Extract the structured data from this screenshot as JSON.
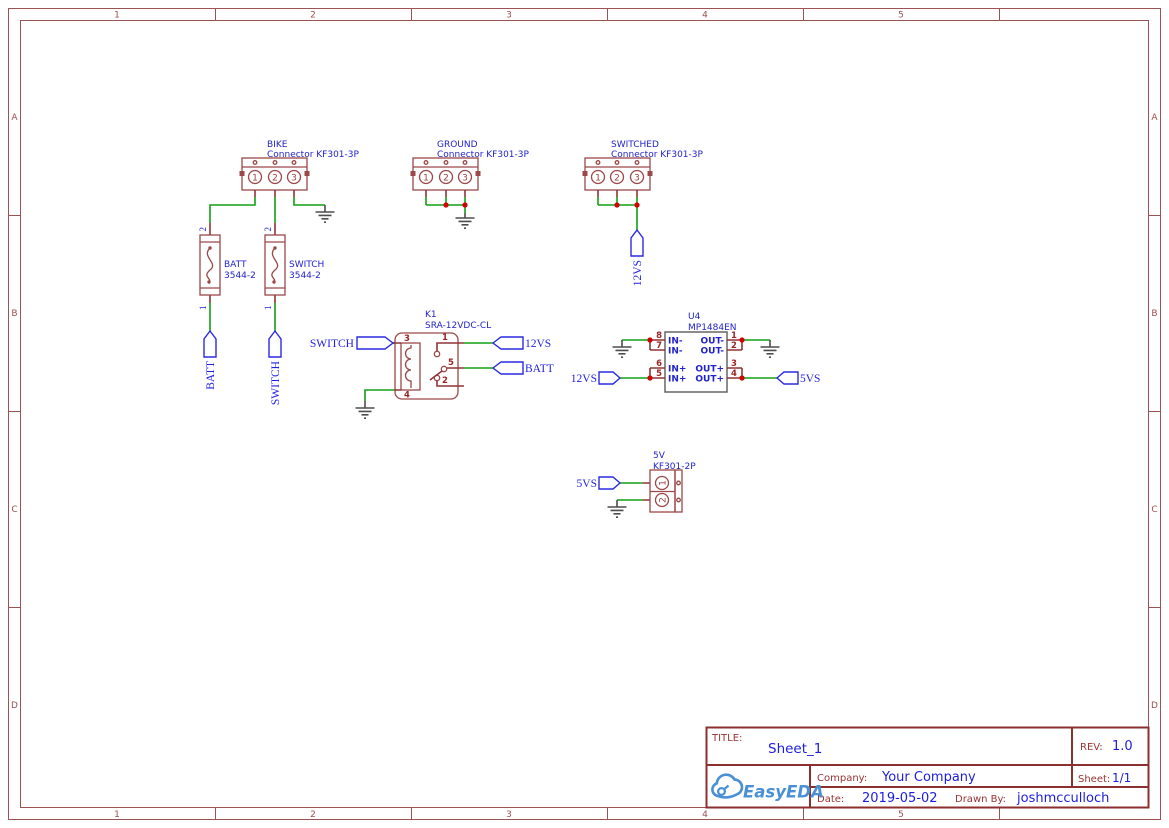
{
  "frame": {
    "cols": [
      "1",
      "2",
      "3",
      "4",
      "5"
    ],
    "rows": [
      "A",
      "B",
      "C",
      "D"
    ]
  },
  "title_block": {
    "title_label": "TITLE:",
    "title": "Sheet_1",
    "rev_label": "REV:",
    "rev": "1.0",
    "company_label": "Company:",
    "company": "Your Company",
    "sheet_label": "Sheet:",
    "sheet": "1/1",
    "date_label": "Date:",
    "date": "2019-05-02",
    "drawn_by_label": "Drawn By:",
    "drawn_by": "joshmcculloch",
    "logo_text": "EasyEDA"
  },
  "colors": {
    "wire_green": "#12a012",
    "symbol_red": "#9c4848",
    "pin_red": "#8f3535",
    "junction_red": "#d40000",
    "net_blue": "#1f1fe6",
    "frame_red": "#9c5353",
    "ground_gray": "#4d4d4d",
    "ic_gray": "#666666",
    "logo_blue": "#4a90d5",
    "label_dark_red": "#993333"
  },
  "components": {
    "bike": {
      "ref": "BIKE",
      "part": "Connector KF301-3P",
      "pins": [
        "1",
        "2",
        "3"
      ]
    },
    "ground_conn": {
      "ref": "GROUND",
      "part": "Connector KF301-3P",
      "pins": [
        "1",
        "2",
        "3"
      ]
    },
    "switched": {
      "ref": "SWITCHED",
      "part": "Connector KF301-3P",
      "pins": [
        "1",
        "2",
        "3"
      ]
    },
    "fuse_batt": {
      "ref": "BATT",
      "part": "3544-2",
      "pin_top": "2",
      "pin_bottom": "1"
    },
    "fuse_switch": {
      "ref": "SWITCH",
      "part": "3544-2",
      "pin_top": "2",
      "pin_bottom": "1"
    },
    "relay": {
      "ref": "K1",
      "part": "SRA-12VDC-CL",
      "pin_coil_top": "3",
      "pin_coil_bottom": "4",
      "pin_no": "1",
      "pin_com": "5",
      "pin_nc": "2"
    },
    "regulator": {
      "ref": "U4",
      "part": "MP1484EN",
      "left_pins": [
        {
          "num": "8",
          "name": "IN-"
        },
        {
          "num": "7",
          "name": "IN-"
        },
        {
          "num": "6",
          "name": "IN+"
        },
        {
          "num": "5",
          "name": "IN+"
        }
      ],
      "right_pins": [
        {
          "num": "1",
          "name": "OUT-"
        },
        {
          "num": "2",
          "name": "OUT-"
        },
        {
          "num": "3",
          "name": "OUT+"
        },
        {
          "num": "4",
          "name": "OUT+"
        }
      ]
    },
    "conn_5v": {
      "ref": "5V",
      "part": "KF301-2P",
      "pins": [
        "1",
        "2"
      ]
    }
  },
  "net_flags": {
    "switch_input": "SWITCH",
    "relay_12vs": "12VS",
    "relay_batt": "BATT",
    "fuse_batt_net": "BATT",
    "fuse_switch_net": "SWITCH",
    "switched_12vs": "12VS",
    "u4_12vs": "12VS",
    "u4_5vs": "5VS",
    "conn5v_5vs": "5VS"
  }
}
